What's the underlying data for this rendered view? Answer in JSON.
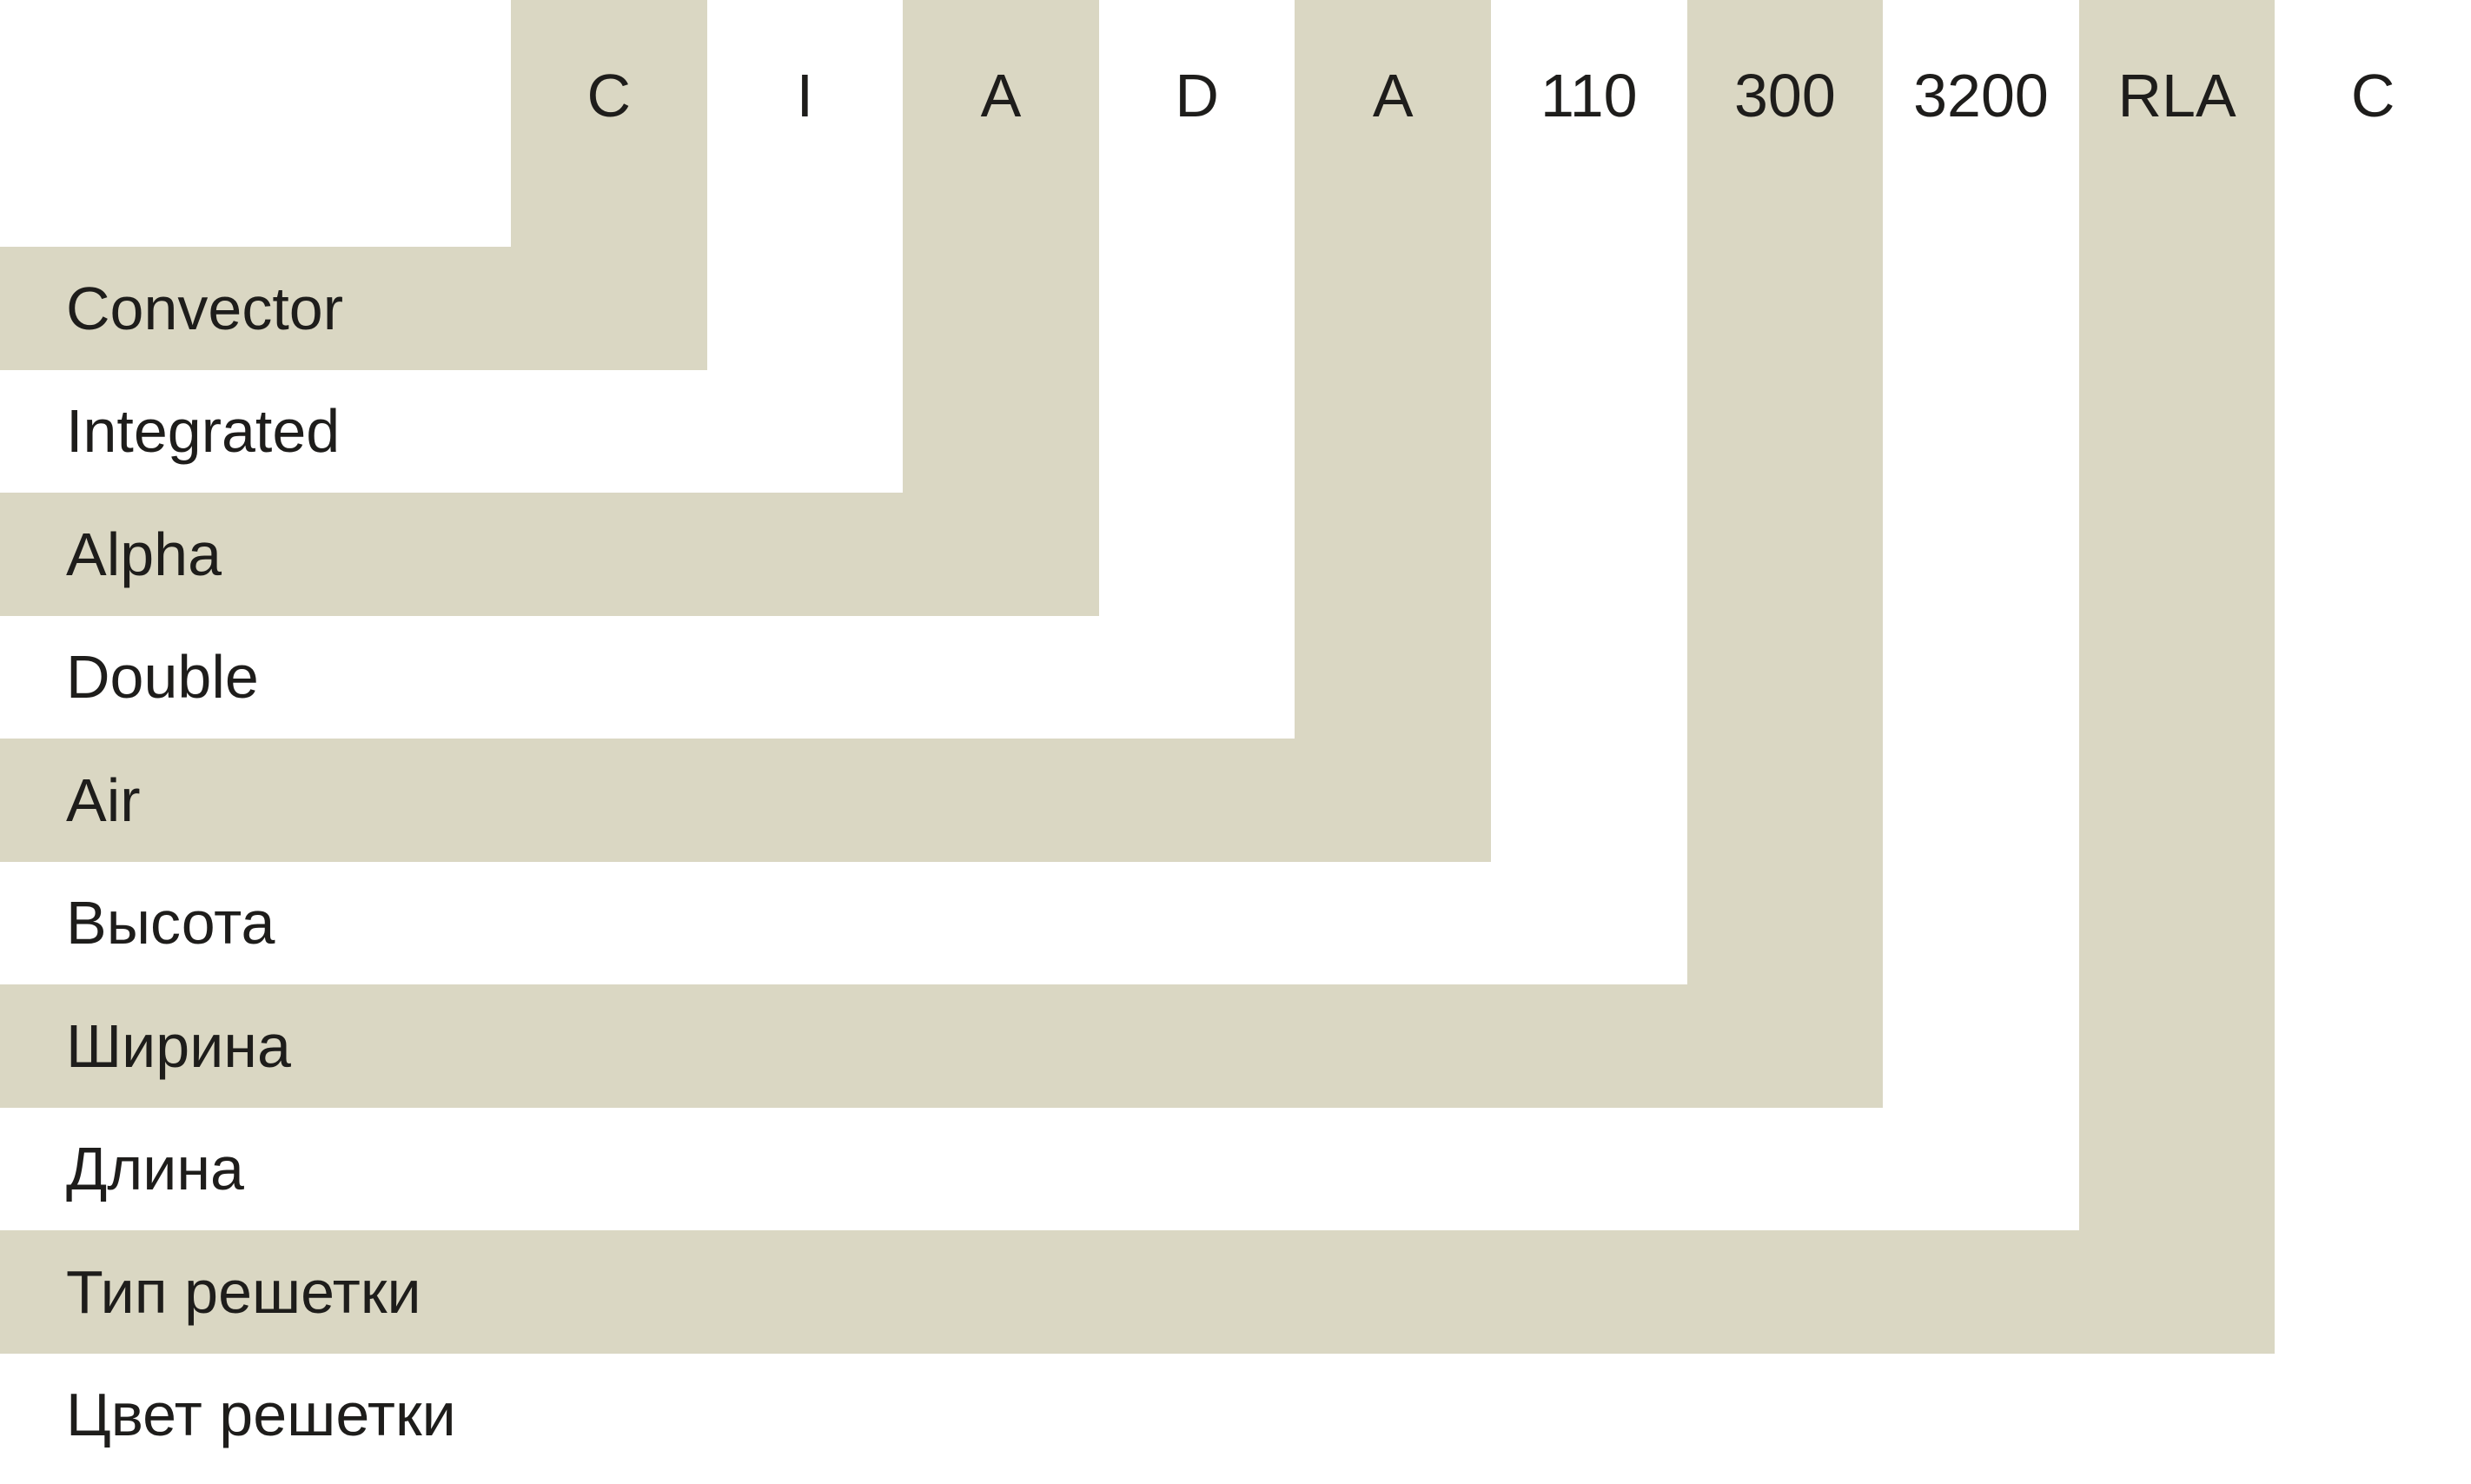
{
  "colors": {
    "background": "#ffffff",
    "stripe": "#dad7c3",
    "text": "#1e1d1b"
  },
  "code": {
    "segments": [
      {
        "code": "C",
        "label": "Convector"
      },
      {
        "code": "I",
        "label": "Integrated"
      },
      {
        "code": "A",
        "label": "Alpha"
      },
      {
        "code": "D",
        "label": "Double"
      },
      {
        "code": "A",
        "label": "Air"
      },
      {
        "code": "110",
        "label": "Высота"
      },
      {
        "code": "300",
        "label": "Ширина"
      },
      {
        "code": "3200",
        "label": "Длина"
      },
      {
        "code": "RLA",
        "label": "Тип решетки"
      },
      {
        "code": "C",
        "label": "Цвет решетки"
      }
    ]
  }
}
